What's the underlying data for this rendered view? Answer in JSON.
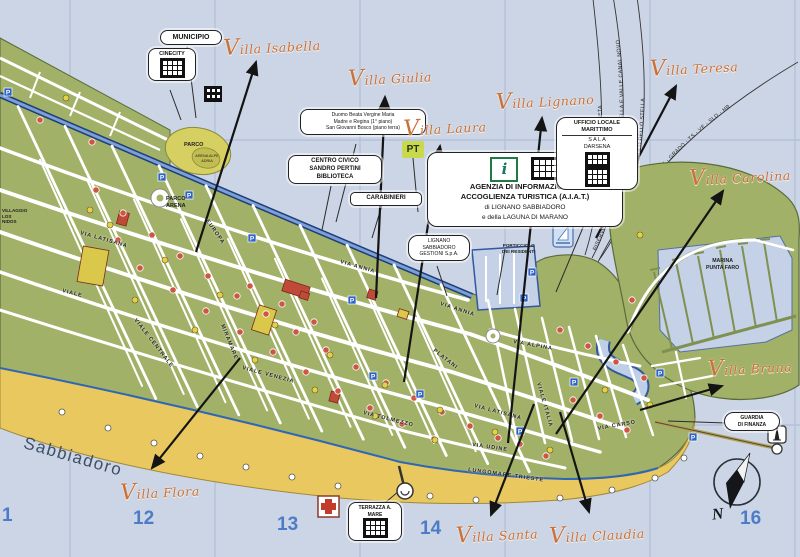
{
  "map_title": "Lignano Sabbiadoro tourist map",
  "region_label": "Sabbiadoro",
  "compass_n": "N",
  "grid_numbers": [
    {
      "label": "1",
      "x": 2,
      "y": 505
    },
    {
      "label": "12",
      "x": 133,
      "y": 508
    },
    {
      "label": "13",
      "x": 277,
      "y": 514
    },
    {
      "label": "14",
      "x": 420,
      "y": 518
    },
    {
      "label": "16",
      "x": 740,
      "y": 508
    }
  ],
  "villas": [
    {
      "name": "Villa Isabella",
      "x": 272,
      "y": 46,
      "head": [
        256,
        62
      ],
      "tail": [
        196,
        252
      ]
    },
    {
      "name": "Villa Giulia",
      "x": 390,
      "y": 77,
      "head": [
        385,
        97
      ],
      "tail": [
        376,
        298
      ]
    },
    {
      "name": "Villa Laura",
      "x": 445,
      "y": 127,
      "head": [
        440,
        146
      ],
      "tail": [
        404,
        382
      ]
    },
    {
      "name": "Villa Lignano",
      "x": 545,
      "y": 100,
      "head": [
        542,
        118
      ],
      "tail": [
        508,
        443
      ]
    },
    {
      "name": "Villa Teresa",
      "x": 694,
      "y": 67,
      "head": [
        676,
        86
      ],
      "tail": [
        596,
        238
      ]
    },
    {
      "name": "Villa Carolina",
      "x": 740,
      "y": 176,
      "head": [
        723,
        191
      ],
      "tail": [
        556,
        434
      ]
    },
    {
      "name": "Villa Bruna",
      "x": 750,
      "y": 367,
      "head": [
        722,
        386
      ],
      "tail": [
        640,
        410
      ]
    },
    {
      "name": "Villa Flora",
      "x": 160,
      "y": 491,
      "head": [
        152,
        468
      ],
      "tail": [
        240,
        358
      ]
    },
    {
      "name": "Villa Santa",
      "x": 497,
      "y": 534,
      "head": [
        491,
        515
      ],
      "tail": [
        534,
        404
      ]
    },
    {
      "name": "Villa Claudia",
      "x": 597,
      "y": 534,
      "head": [
        589,
        512
      ],
      "tail": [
        560,
        412
      ]
    }
  ],
  "streets": [
    {
      "label": "VIA LATISANA",
      "x": 80,
      "y": 234,
      "rot": 16
    },
    {
      "label": "VIA LATISANA",
      "x": 474,
      "y": 407,
      "rot": 15
    },
    {
      "label": "VIALE CENTRALE",
      "x": 134,
      "y": 320,
      "rot": 52
    },
    {
      "label": "VIALE VENEZIA",
      "x": 242,
      "y": 369,
      "rot": 15
    },
    {
      "label": "VIALE",
      "x": 62,
      "y": 292,
      "rot": 14
    },
    {
      "label": "VIA ANNIA",
      "x": 340,
      "y": 263,
      "rot": 16
    },
    {
      "label": "VIA ANNIA",
      "x": 440,
      "y": 305,
      "rot": 18
    },
    {
      "label": "VIA TOLMEZZO",
      "x": 363,
      "y": 414,
      "rot": 14
    },
    {
      "label": "LUNGOMARE TRIESTE",
      "x": 468,
      "y": 471,
      "rot": 8
    },
    {
      "label": "VIALE ITALIA",
      "x": 537,
      "y": 383,
      "rot": 74
    },
    {
      "label": "VIA ALPINA",
      "x": 513,
      "y": 343,
      "rot": 10
    },
    {
      "label": "PLATANI",
      "x": 433,
      "y": 351,
      "rot": 38
    },
    {
      "label": "EUROPA",
      "x": 206,
      "y": 221,
      "rot": 55
    },
    {
      "label": "VIA CARSO",
      "x": 598,
      "y": 430,
      "rot": -10
    },
    {
      "label": "VIA UDINE",
      "x": 472,
      "y": 446,
      "rot": 8
    },
    {
      "label": "MIRAMARE",
      "x": 221,
      "y": 325,
      "rot": 68
    }
  ],
  "routes": [
    {
      "label": "APRILIA MARITTIMA - LITORANEA VENETA",
      "path": "M 585,255 C 612,170 600,60 592,-10",
      "offset": "12%"
    },
    {
      "label": "RISERVE NATURALI REGIONALI FOCI DELLO STELLA E VALLE CANAL NOVO",
      "path": "M 592,258 C 634,180 626,70 612,-10",
      "offset": "3%"
    },
    {
      "label": "MARANO LAGUNARE - PALAZZOLO DELLO STELLA",
      "path": "M 599,260 C 655,185 648,70 636,-10",
      "offset": "10%"
    },
    {
      "label": "ISOLE - GRADO - TS - VE - SLO - HR",
      "path": "M 598,262 C 640,180 700,120 798,62",
      "offset": "36%"
    }
  ],
  "callouts": {
    "municipio": "MUNICIPIO",
    "cinecity": "CINECITY",
    "duomo_lines": [
      "Duomo Beata Vergine Maria",
      "Madre e Regina (1° piano)",
      "San Giovanni Bosco (piano terra)"
    ],
    "centro_lines": [
      "CENTRO CIVICO",
      "SANDRO PERTINI",
      "BIBLIOTECA"
    ],
    "carabinieri": "CARABINIERI",
    "agenzia_lines": [
      "AGENZIA DI INFORMAZIONE E",
      "ACCOGLIENZA TURISTICA (A.I.A.T.)",
      "di LIGNANO SABBIADORO",
      "e della LAGUNA DI MARANO"
    ],
    "info_i": "i",
    "ufficio_lines": [
      "UFFICIO LOCALE",
      "MARITTIMO",
      "S A L A",
      "DARSENA"
    ],
    "gestioni_lines": [
      "LIGNANO",
      "SABBIADORO",
      "GESTIONI S.p.A."
    ],
    "porticciolo_lines": [
      "PORTICCIOLO",
      "DEI RESIDENTI"
    ],
    "marina_lines": [
      "MARINA",
      "PUNTA FARO"
    ],
    "guardia_lines": [
      "GUARDIA",
      "DI FINANZA"
    ],
    "terrazza_lines": [
      "TERRAZZA",
      "A. MARE"
    ],
    "pt": "PT",
    "parco": "PARCO",
    "arena_alpe": "ARENA ALPE ADRIA",
    "parco_arena_lines": [
      "PARCO",
      "ARENA"
    ],
    "villaggio_lines": [
      "VILLAGGIO",
      "LOS",
      "NIDOS"
    ]
  },
  "colors": {
    "water": "#ccd5e5",
    "land": "#a2b168",
    "beach": "#eac860",
    "canal": "#1d3d7c",
    "accent_script": "#c9703b",
    "grid_number": "#4d7cc7",
    "parking": "#2e62c4",
    "poi_red": "#cd5743",
    "poi_yellow": "#e3cf4e"
  },
  "markers": {
    "red": [
      [
        96,
        190
      ],
      [
        123,
        213
      ],
      [
        152,
        235
      ],
      [
        180,
        256
      ],
      [
        208,
        276
      ],
      [
        237,
        296
      ],
      [
        266,
        314
      ],
      [
        296,
        332
      ],
      [
        326,
        350
      ],
      [
        356,
        367
      ],
      [
        386,
        383
      ],
      [
        414,
        398
      ],
      [
        442,
        412
      ],
      [
        470,
        426
      ],
      [
        498,
        438
      ],
      [
        140,
        268
      ],
      [
        173,
        290
      ],
      [
        206,
        311
      ],
      [
        240,
        332
      ],
      [
        273,
        352
      ],
      [
        306,
        372
      ],
      [
        338,
        391
      ],
      [
        370,
        408
      ],
      [
        402,
        424
      ],
      [
        434,
        439
      ],
      [
        520,
        444
      ],
      [
        546,
        456
      ],
      [
        573,
        400
      ],
      [
        600,
        416
      ],
      [
        627,
        430
      ],
      [
        560,
        330
      ],
      [
        588,
        346
      ],
      [
        616,
        362
      ],
      [
        644,
        378
      ],
      [
        118,
        240
      ],
      [
        250,
        286
      ],
      [
        282,
        304
      ],
      [
        314,
        322
      ],
      [
        632,
        300
      ],
      [
        40,
        120
      ],
      [
        92,
        142
      ]
    ],
    "yellow": [
      [
        110,
        225
      ],
      [
        165,
        260
      ],
      [
        220,
        295
      ],
      [
        275,
        325
      ],
      [
        330,
        355
      ],
      [
        385,
        385
      ],
      [
        440,
        410
      ],
      [
        495,
        432
      ],
      [
        550,
        450
      ],
      [
        135,
        300
      ],
      [
        195,
        330
      ],
      [
        255,
        360
      ],
      [
        315,
        390
      ],
      [
        375,
        416
      ],
      [
        435,
        440
      ],
      [
        605,
        390
      ],
      [
        650,
        405
      ],
      [
        90,
        210
      ],
      [
        640,
        235
      ],
      [
        66,
        98
      ]
    ],
    "white": [
      [
        62,
        412
      ],
      [
        108,
        428
      ],
      [
        154,
        443
      ],
      [
        200,
        456
      ],
      [
        246,
        467
      ],
      [
        292,
        477
      ],
      [
        338,
        486
      ],
      [
        430,
        496
      ],
      [
        476,
        500
      ],
      [
        560,
        498
      ],
      [
        612,
        490
      ],
      [
        655,
        478
      ],
      [
        684,
        458
      ]
    ],
    "parking": [
      [
        162,
        177
      ],
      [
        189,
        195
      ],
      [
        252,
        238
      ],
      [
        352,
        300
      ],
      [
        373,
        376
      ],
      [
        532,
        272
      ],
      [
        524,
        298
      ],
      [
        574,
        382
      ],
      [
        520,
        431
      ],
      [
        660,
        373
      ],
      [
        693,
        437
      ],
      [
        420,
        394
      ],
      [
        8,
        92
      ]
    ]
  }
}
